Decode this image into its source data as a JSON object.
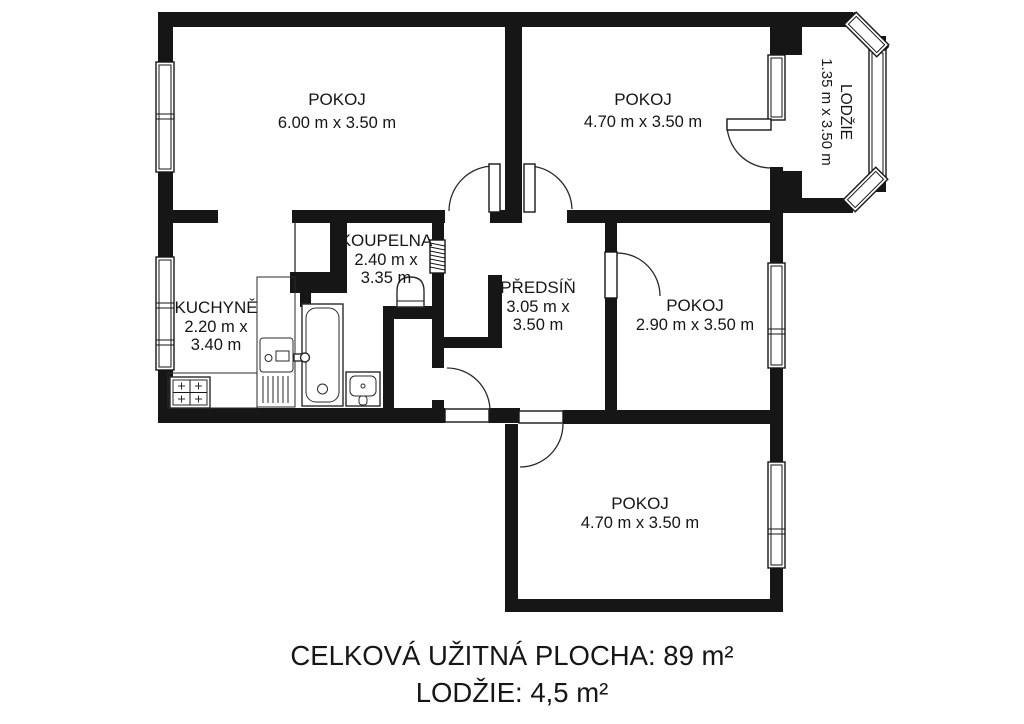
{
  "rooms": {
    "pokoj_top_left": {
      "name": "POKOJ",
      "dims": "6.00 m x 3.50 m"
    },
    "pokoj_top_right": {
      "name": "POKOJ",
      "dims": "4.70 m x 3.50 m"
    },
    "lodzie": {
      "name": "LODŽIE",
      "dims": "1.35 m x 3.50 m"
    },
    "koupelna": {
      "name": "KOUPELNA",
      "dims_line1": "2.40 m x",
      "dims_line2": "3.35 m"
    },
    "kuchyne": {
      "name": "KUCHYNĚ",
      "dims_line1": "2.20 m x",
      "dims_line2": "3.40 m"
    },
    "predsin": {
      "name": "PŘEDSÍŇ",
      "dims_line1": "3.05 m x",
      "dims_line2": "3.50 m"
    },
    "pokoj_middle_right": {
      "name": "POKOJ",
      "dims": "2.90 m x 3.50 m"
    },
    "pokoj_bottom": {
      "name": "POKOJ",
      "dims": "4.70 m x 3.50 m"
    }
  },
  "summary": {
    "line1": "CELKOVÁ UŽITNÁ PLOCHA: 89 m²",
    "line2": "LODŽIE: 4,5 m²"
  },
  "icons": [
    "stove-icon",
    "kitchen-sink-icon",
    "bathtub-icon",
    "tap-icon",
    "washbasin-icon",
    "toilet-icon",
    "window",
    "door"
  ],
  "colors": {
    "wall": "#161616",
    "background": "#ffffff"
  }
}
